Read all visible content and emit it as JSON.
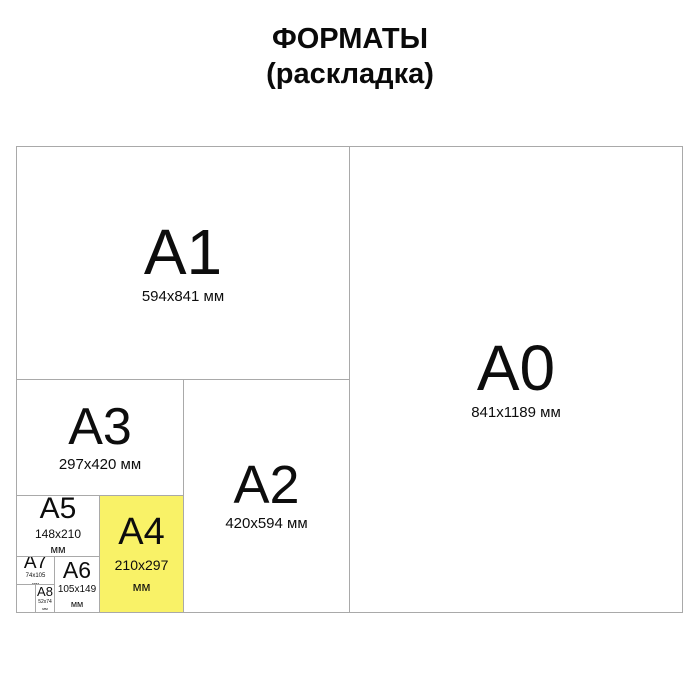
{
  "title": {
    "line1": "ФОРМАТЫ",
    "line2": "(раскладка)"
  },
  "colors": {
    "highlight_yellow": "#f9f267",
    "line_gray": "#a9a9a9",
    "text_black": "#0d0d0d"
  },
  "formats": {
    "a0": {
      "label": "A0",
      "size": "841x1189 мм"
    },
    "a1": {
      "label": "A1",
      "size": "594x841 мм"
    },
    "a2": {
      "label": "A2",
      "size": "420x594 мм"
    },
    "a3": {
      "label": "A3",
      "size": "297x420 мм"
    },
    "a4": {
      "label": "A4",
      "size": "210x297",
      "unit": "мм",
      "highlighted": true
    },
    "a5": {
      "label": "A5",
      "size": "148x210",
      "unit": "мм"
    },
    "a6": {
      "label": "A6",
      "size": "105x149",
      "unit": "мм"
    },
    "a7": {
      "label": "A7",
      "size": "74x105",
      "unit": "мм"
    },
    "a8": {
      "label": "A8",
      "size": "52x74",
      "unit": "мм"
    }
  }
}
